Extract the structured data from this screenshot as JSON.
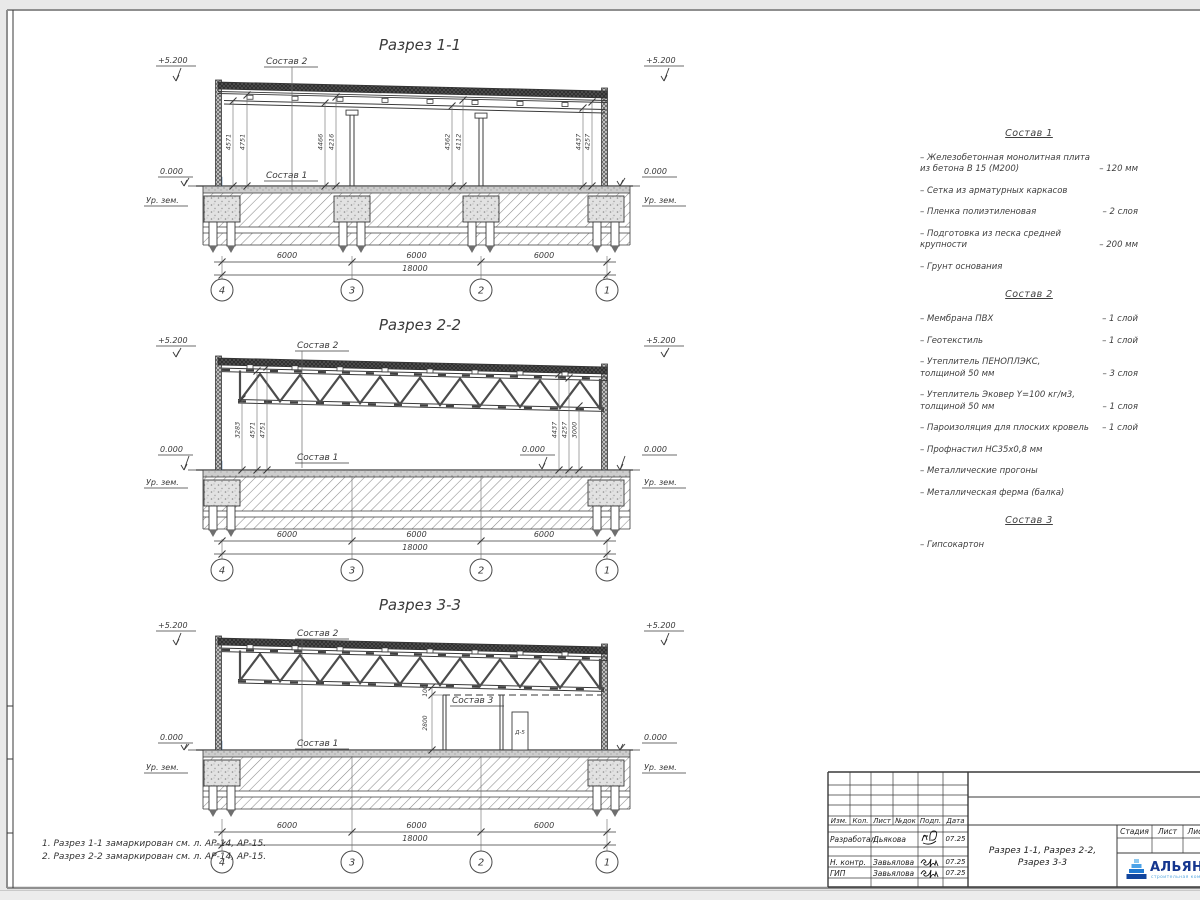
{
  "sections": {
    "s1": {
      "title": "Разрез 1-1",
      "elev_top": "+5.200",
      "elev_zero": "0.000",
      "ground": "Ур. зем.",
      "label_sostav2": "Состав 2",
      "label_sostav1": "Состав 1",
      "vdims": [
        "4571",
        "4751",
        "4466",
        "4216",
        "4362",
        "4112",
        "4437",
        "4257"
      ],
      "spans": [
        "6000",
        "6000",
        "6000"
      ],
      "total": "18000",
      "axes": [
        "4",
        "3",
        "2",
        "1"
      ]
    },
    "s2": {
      "title": "Разрез 2-2",
      "elev_top": "+5.200",
      "elev_zero": "0.000",
      "ground": "Ур. зем.",
      "label_sostav2": "Состав 2",
      "label_sostav1": "Состав 1",
      "vdims": [
        "3283",
        "4571",
        "4751",
        "4437",
        "4257",
        "3000"
      ],
      "spans": [
        "6000",
        "6000",
        "6000"
      ],
      "total": "18000",
      "axes": [
        "4",
        "3",
        "2",
        "1"
      ]
    },
    "s3": {
      "title": "Разрез 3-3",
      "elev_top": "+5.200",
      "elev_zero": "0.000",
      "ground": "Ур. зем.",
      "label_sostav2": "Состав 2",
      "label_sostav1": "Состав 1",
      "label_sostav3": "Состав 3",
      "door_label": "Д-5",
      "vdims": [
        "100",
        "2800"
      ],
      "spans": [
        "6000",
        "6000",
        "6000"
      ],
      "total": "18000",
      "axes": [
        "4",
        "3",
        "2",
        "1"
      ]
    }
  },
  "compositions": [
    {
      "title": "Состав 1",
      "items": [
        {
          "text": "– Железобетонная  монолитная плита\nиз бетона В 15 (М200)",
          "value": "– 120 мм"
        },
        {
          "text": "– Сетка из арматурных каркасов",
          "value": ""
        },
        {
          "text": "– Пленка полиэтиленовая",
          "value": "– 2 слоя"
        },
        {
          "text": "– Подготовка из песка средней\nкрупности",
          "value": "– 200 мм"
        },
        {
          "text": "– Грунт основания",
          "value": ""
        }
      ]
    },
    {
      "title": "Состав 2",
      "items": [
        {
          "text": "– Мембрана ПВХ",
          "value": "– 1 слой"
        },
        {
          "text": "– Геотекстиль",
          "value": "– 1 слой"
        },
        {
          "text": "– Утеплитель ПЕНОПЛЭКС,\nтолщиной 50 мм",
          "value": "– 3 слоя"
        },
        {
          "text": "– Утеплитель Эковер Y=100 кг/м3,\nтолщиной 50 мм",
          "value": "– 1 слоя"
        },
        {
          "text": "– Пароизоляция для плоских кровель",
          "value": "– 1 слой"
        },
        {
          "text": "– Профнастил НС35х0,8 мм",
          "value": ""
        },
        {
          "text": "– Металлические прогоны",
          "value": ""
        },
        {
          "text": "– Металлическая ферма (балка)",
          "value": ""
        }
      ]
    },
    {
      "title": "Состав 3",
      "items": [
        {
          "text": "– Гипсокартон",
          "value": ""
        }
      ]
    }
  ],
  "notes": [
    "1. Разрез 1-1 замаркирован см. л. АР-14, АР-15.",
    "2. Разрез 2-2 замаркирован см. л. АР-14, АР-15."
  ],
  "titleblock": {
    "cols": [
      "Изм.",
      "Кол.",
      "Лист",
      "№док",
      "Подп.",
      "Дата"
    ],
    "rows": [
      {
        "role": "Разработал",
        "name": "Дьякова",
        "date": "07.25"
      },
      {
        "role": "Н. контр.",
        "name": "Завьялова",
        "date": "07.25"
      },
      {
        "role": "ГИП",
        "name": "Завьялова",
        "date": "07.25"
      }
    ],
    "doc_title_line1": "Разрез 1-1, Разрез 2-2,",
    "doc_title_line2": "Рзарез 3-3",
    "stage_cols": [
      "Стадия",
      "Лист",
      "Лис"
    ],
    "logo_text": "АЛЬЯН",
    "logo_sub": "строительная ком",
    "accent_blue": "#15368f"
  }
}
